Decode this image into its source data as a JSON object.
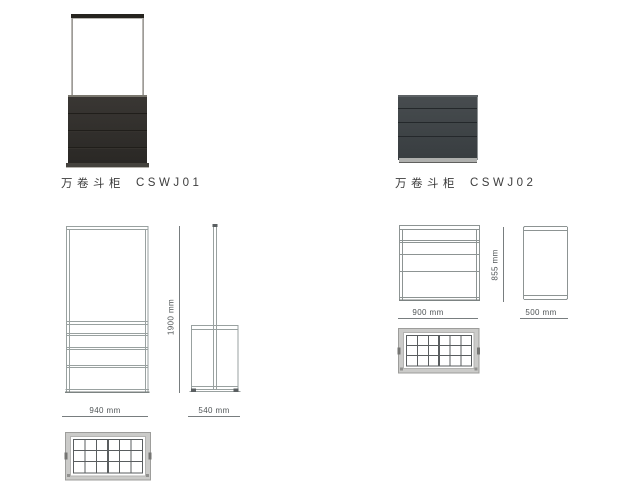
{
  "page": {
    "background": "#ffffff"
  },
  "products": [
    {
      "name": "万卷斗柜",
      "code": "CSWJ01",
      "dimensions": {
        "width": "940 mm",
        "depth": "540 mm",
        "height": "1900 mm"
      }
    },
    {
      "name": "万卷斗柜",
      "code": "CSWJ02",
      "dimensions": {
        "width": "900 mm",
        "depth": "500 mm",
        "height": "855 mm"
      }
    }
  ],
  "colors": {
    "photo1_frame_bar": "#26241f",
    "photo1_cabinet": "#2f2c29",
    "photo2_cabinet": "#3f4447",
    "drawing_line": "#99a1a0",
    "dimension_line": "#787d7f",
    "dimension_text": "#4f5456",
    "label_text": "#3d3d3d",
    "grid_frame": "#cbcbc9",
    "grid_line": "#595d5f"
  }
}
